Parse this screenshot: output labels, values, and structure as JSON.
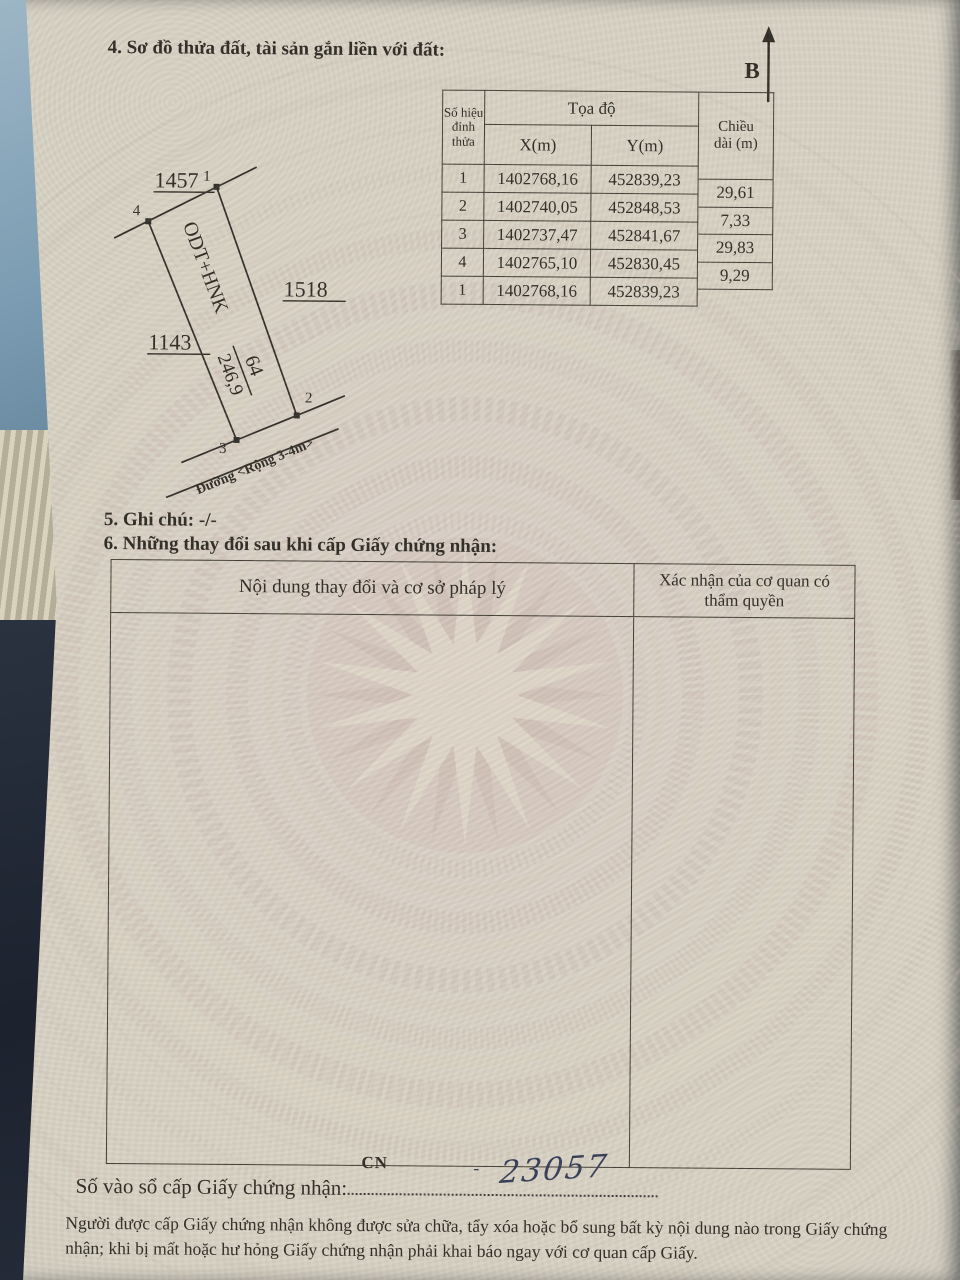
{
  "document": {
    "section4_title": "4. Sơ đồ thửa đất, tài sản gắn liền với đất:",
    "north_label": "B",
    "section5_text": "5. Ghi chú: -/-",
    "section6_title": "6. Những thay đổi sau khi cấp Giấy chứng nhận:",
    "registry_label": "Số vào sổ cấp Giấy chứng nhận:",
    "registry_cn": "CN",
    "registry_dash": "-",
    "registry_number": "23057",
    "footer_note": "Người được cấp Giấy chứng nhận không được sửa chữa, tẩy xóa hoặc bổ sung bất kỳ nội dung nào trong Giấy chứng nhận; khi bị mất hoặc hư hỏng Giấy chứng nhận phải khai báo ngay với cơ quan cấp Giấy."
  },
  "coordinate_table": {
    "header_vertex": "Số hiệu đỉnh thửa",
    "header_coords": "Tọa độ",
    "header_x": "X(m)",
    "header_y": "Y(m)",
    "header_length": "Chiều dài (m)",
    "rows": [
      {
        "vertex": "1",
        "x": "1402768,16",
        "y": "452839,23"
      },
      {
        "vertex": "2",
        "x": "1402740,05",
        "y": "452848,53"
      },
      {
        "vertex": "3",
        "x": "1402737,47",
        "y": "452841,67"
      },
      {
        "vertex": "4",
        "x": "1402765,10",
        "y": "452830,45"
      },
      {
        "vertex": "1",
        "x": "1402768,16",
        "y": "452839,23"
      }
    ],
    "lengths": [
      "29,61",
      "7,33",
      "29,83",
      "9,29"
    ]
  },
  "plot_diagram": {
    "parcel_top": "1457",
    "parcel_right": "1518",
    "parcel_left": "1143",
    "vertex_labels": [
      "1",
      "2",
      "3",
      "4"
    ],
    "land_use_code": "ODT+HNK",
    "parcel_number": "64",
    "area": "246,9",
    "road_label": "Đường <Rộng 3-4m>"
  },
  "section6_table": {
    "col1_header": "Nội dung thay đổi và cơ sở pháp lý",
    "col2_header": "Xác nhận của cơ quan có thẩm quyền"
  },
  "colors": {
    "paper": "#d8d2c4",
    "ink": "#2b2822",
    "watermark_pink": "#ccb5aa",
    "watermark_cream": "#e5dfcc",
    "handwriting_ink": "#323a55"
  }
}
